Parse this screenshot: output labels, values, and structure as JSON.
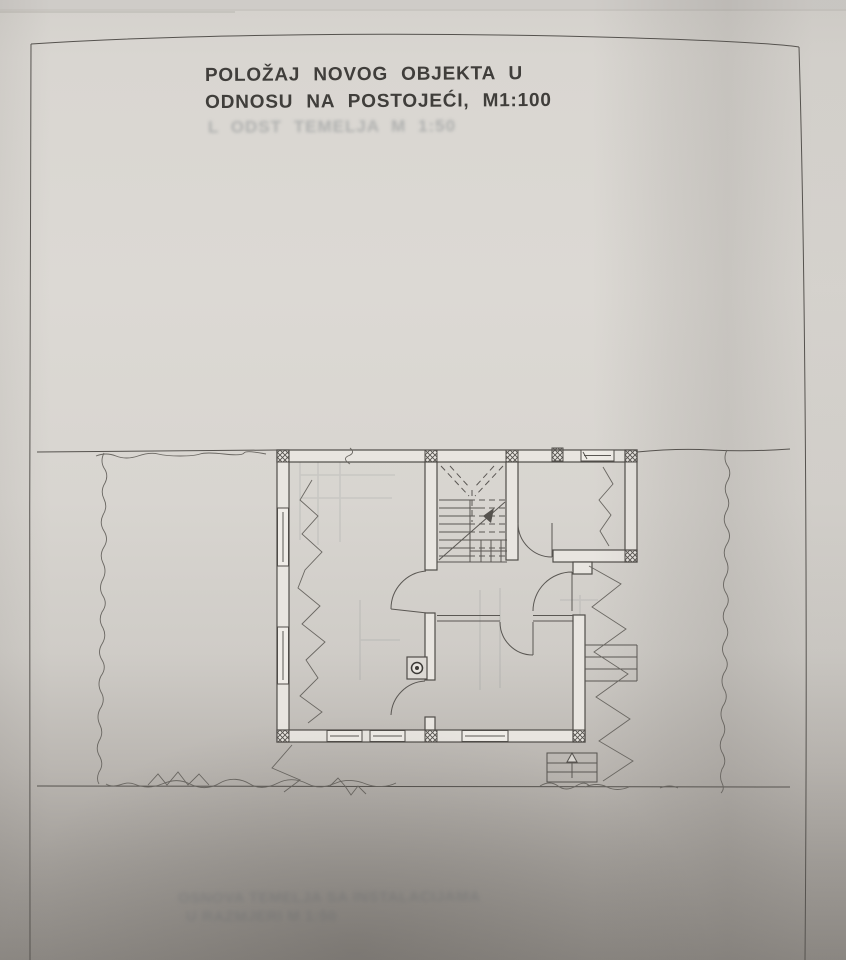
{
  "page": {
    "kind": "scanned architectural drawing",
    "paper_hex": "#d9d6d1",
    "ink_hex": "#504d49"
  },
  "header": {
    "title_line1": "POLOŽAJ NOVOG OBJEKTA U",
    "title_line2": "ODNOSU NA POSTOJEĆI, M1:100",
    "scale_label": "M1:100"
  },
  "bleedthrough": {
    "legibility": "faint ink bleed-through, barely legible",
    "top_line": "L ODST TEMELJA M 1:50",
    "bottom_line1": "OSNOVA TEMELJA SA INSTALACIJAMA",
    "bottom_line2": "U RAZMJERI M 1:50"
  },
  "floor_plan": {
    "symbols": [
      "load-bearing-wall",
      "crosshatched-masonry-column",
      "window-symbol",
      "door-swing-arc",
      "staircase-with-up-arrow",
      "chimney-flue-symbol",
      "zigzag-break-line",
      "terrain-boundary-line",
      "exterior-entrance-steps",
      "side-terrace-steps"
    ]
  }
}
